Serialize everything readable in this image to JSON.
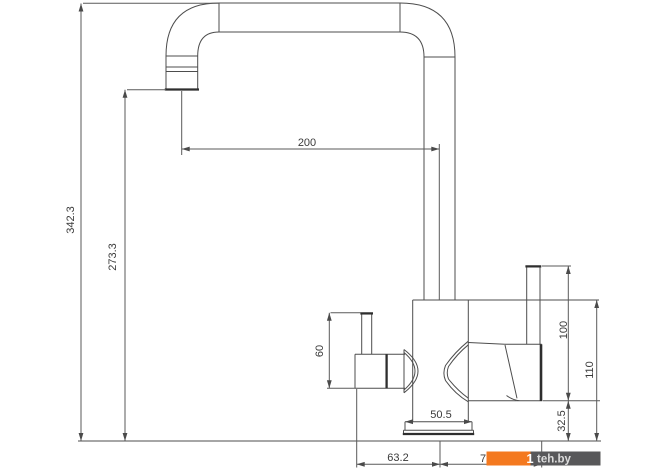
{
  "drawing": {
    "type": "faucet-technical-dimension-drawing",
    "dims": {
      "overall_height": "342.3",
      "spout_outlet_height": "273.3",
      "spout_reach": "200",
      "left_handle_height": "60",
      "right_handle_height": "100",
      "body_height": "110",
      "handle_bottom_offset": "32.5",
      "base_width": "50.5",
      "left_span": "63.2",
      "right_span_partial": "7"
    }
  },
  "watermark": {
    "text": "teh.by",
    "logo_glyph": "1",
    "orange": "#f4791f",
    "dark": "#58585a"
  },
  "colors": {
    "line": "#4d4d4d",
    "text": "#3a3a3a",
    "background": "#ffffff"
  }
}
